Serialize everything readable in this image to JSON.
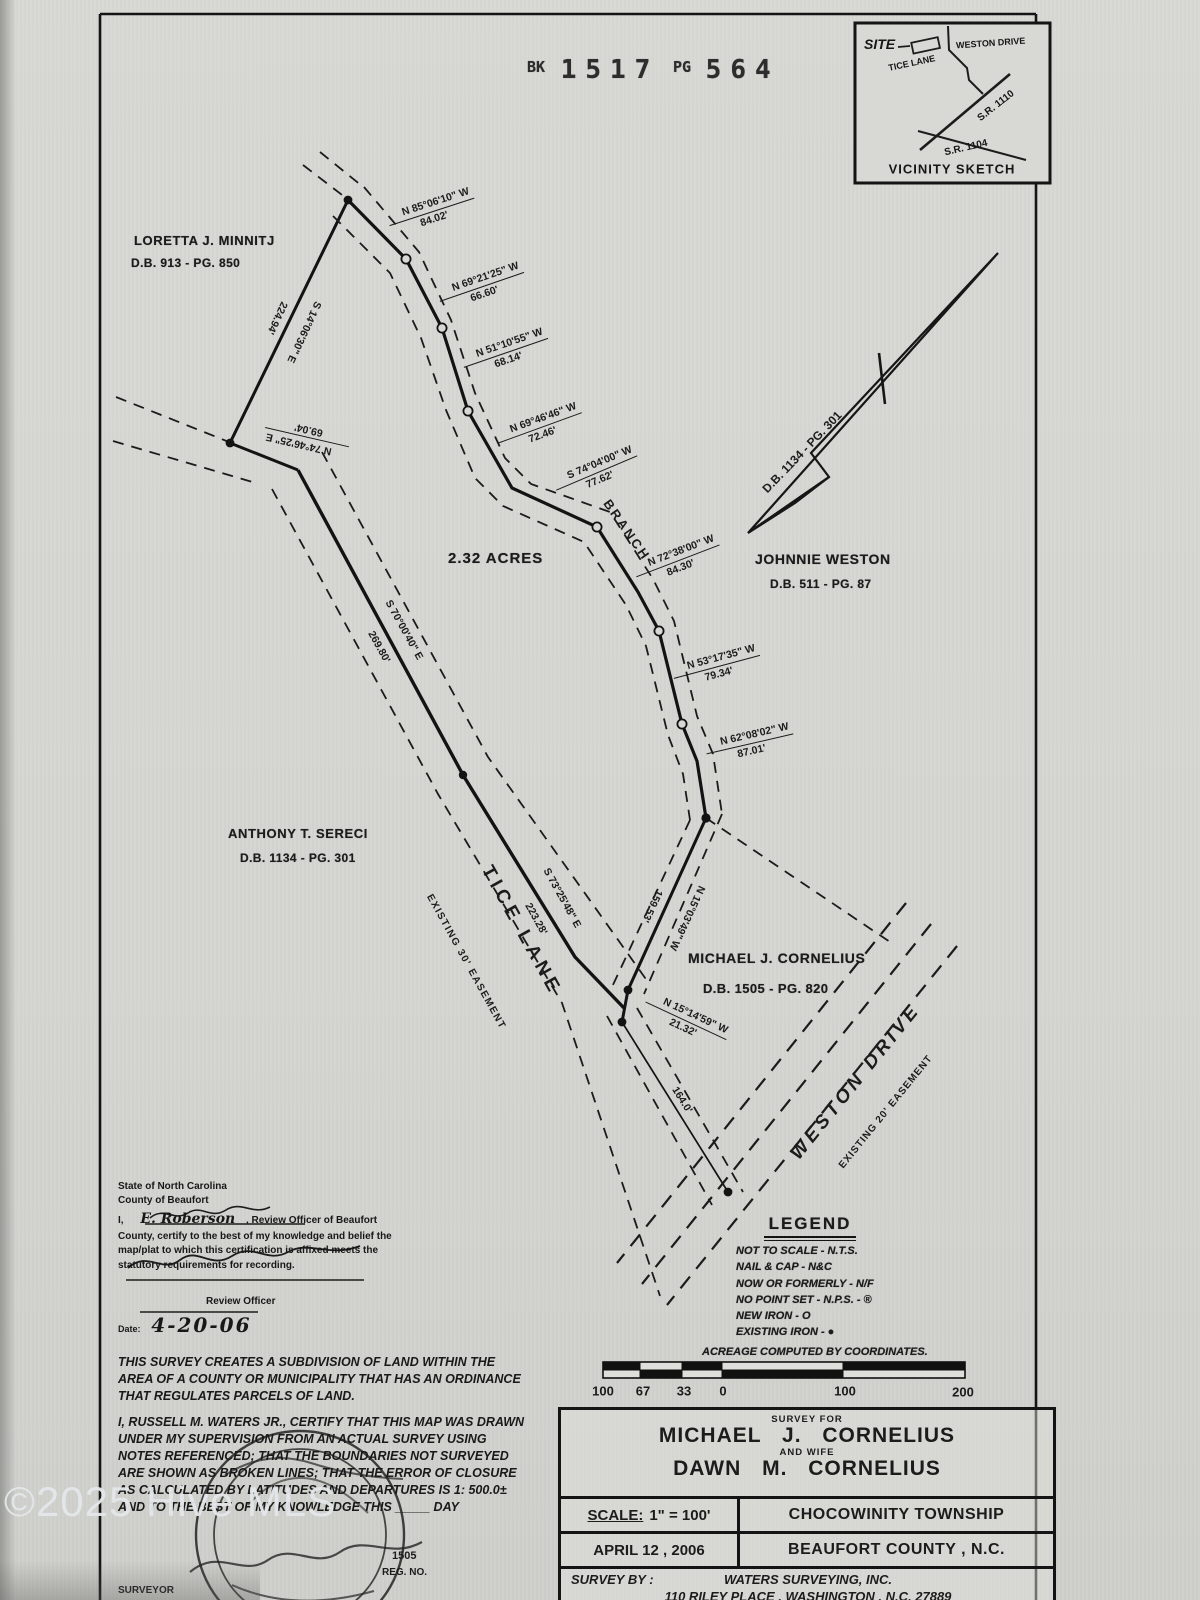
{
  "stamp": {
    "bk": "BK",
    "book": "1517",
    "pg": "PG",
    "page": "564"
  },
  "watermark": {
    "text": "©2025 Hive MLS"
  },
  "vicinity": {
    "title": "VICINITY SKETCH",
    "site": "SITE",
    "tice": "TICE LANE",
    "weston": "WESTON DRIVE",
    "sr1110": "S.R. 1110",
    "sr1104": "S.R. 1104"
  },
  "parcel": {
    "acreage": "2.32 ACRES",
    "branch": "BRANCH"
  },
  "owners": {
    "minnitj": {
      "name": "LORETTA J. MINNITJ",
      "deed": "D.B. 913 - PG. 850"
    },
    "weston": {
      "name": "JOHNNIE WESTON",
      "deed": "D.B. 511 - PG. 87"
    },
    "sereci": {
      "name": "ANTHONY T. SERECI",
      "deed": "D.B. 1134 - PG. 301"
    },
    "cornelius": {
      "name": "MICHAEL J. CORNELIUS",
      "deed": "D.B. 1505 - PG. 820"
    },
    "arrow_deed": "D.B. 1134 - PG. 301"
  },
  "roads": {
    "tice": {
      "name": "TICE LANE",
      "easement": "EXISTING 30' EASEMENT"
    },
    "weston": {
      "name": "WESTON DRIVE",
      "easement": "EXISTING 20' EASEMENT"
    }
  },
  "bearings": [
    {
      "b": "N 85°06'10\" W",
      "d": "84.02'"
    },
    {
      "b": "N 69°21'25\" W",
      "d": "66.60'"
    },
    {
      "b": "N 51°10'55\" W",
      "d": "68.14'"
    },
    {
      "b": "N 69°46'46\" W",
      "d": "72.46'"
    },
    {
      "b": "S 74°04'00\" W",
      "d": "77.62'"
    },
    {
      "b": "N 72°38'00\" W",
      "d": "84.30'"
    },
    {
      "b": "N 53°17'35\" W",
      "d": "79.34'"
    },
    {
      "b": "N 62°08'02\" W",
      "d": "87.01'"
    },
    {
      "b": "S 14°06'30\" E",
      "d": "224.94'"
    },
    {
      "b": "N 74°46'25\" E",
      "d": "69.04'"
    },
    {
      "b": "S 70°00'40\" E",
      "d": "269.80'"
    },
    {
      "b": "S 73°25'48\" E",
      "d": "223.28'"
    },
    {
      "b": "N 15°03'49\" W",
      "d": "159.53'"
    },
    {
      "b": "N 15°14'59\" W",
      "d": "21.32'"
    },
    {
      "b": "",
      "d": "164.0'"
    }
  ],
  "certification": {
    "state": "State of North Carolina",
    "county": "County of Beaufort",
    "i": "I,",
    "officer": "E. Roberson",
    "suffix": ", Review Officer of Beaufort",
    "body1": "County, certify to the best of my knowledge and belief the",
    "body2": "map/plat to which this certification is affixed meets the",
    "body3": "statutory requirements for recording.",
    "officer_title": "Review Officer",
    "date_label": "Date:",
    "date": "4-20-06"
  },
  "legend": {
    "title": "LEGEND",
    "items": [
      "NOT TO SCALE - N.T.S.",
      "NAIL & CAP - N&C",
      "NOW OR FORMERLY - N/F",
      "NO POINT SET - N.P.S. - ®",
      "NEW IRON - O",
      "EXISTING IRON - ●"
    ],
    "footer": "ACREAGE COMPUTED BY COORDINATES."
  },
  "scalebar": {
    "labels": [
      "100",
      "67",
      "33",
      "0",
      "100",
      "200"
    ]
  },
  "notes": {
    "subdivision": "THIS SURVEY CREATES A SUBDIVISION OF LAND WITHIN THE AREA OF A COUNTY OR MUNICIPALITY THAT HAS AN ORDINANCE THAT REGULATES PARCELS OF LAND.",
    "certify": "I, RUSSELL M. WATERS JR., CERTIFY THAT THIS MAP WAS DRAWN UNDER MY SUPERVISION FROM AN ACTUAL SURVEY USING NOTES REFERENCED; THAT THE BOUNDARIES NOT SURVEYED ARE SHOWN AS BROKEN LINES; THAT THE ERROR OF CLOSURE AS CALCULATED BY LATITUDES AND DEPARTURES IS 1: 500.0± AND TO THE BEST OF MY KNOWLEDGE THIS _____ DAY"
  },
  "seal": {
    "reg_no": "1505",
    "reg_label": "REG. NO.",
    "surveyor": "SURVEYOR"
  },
  "titleblock": {
    "survey_for": "SURVEY FOR",
    "client1": "MICHAEL J. CORNELIUS",
    "and_wife": "AND WIFE",
    "client2": "DAWN M. CORNELIUS",
    "scale_label": "SCALE:",
    "scale": "1\" = 100'",
    "township": "CHOCOWINITY TOWNSHIP",
    "date": "APRIL 12 , 2006",
    "county": "BEAUFORT COUNTY , N.C.",
    "survey_by": "SURVEY BY :",
    "firm": "WATERS SURVEYING, INC.",
    "address": "110 RILEY PLACE , WASHINGTON , N.C. 27889",
    "phone": "TEL. 252-946-0700"
  }
}
